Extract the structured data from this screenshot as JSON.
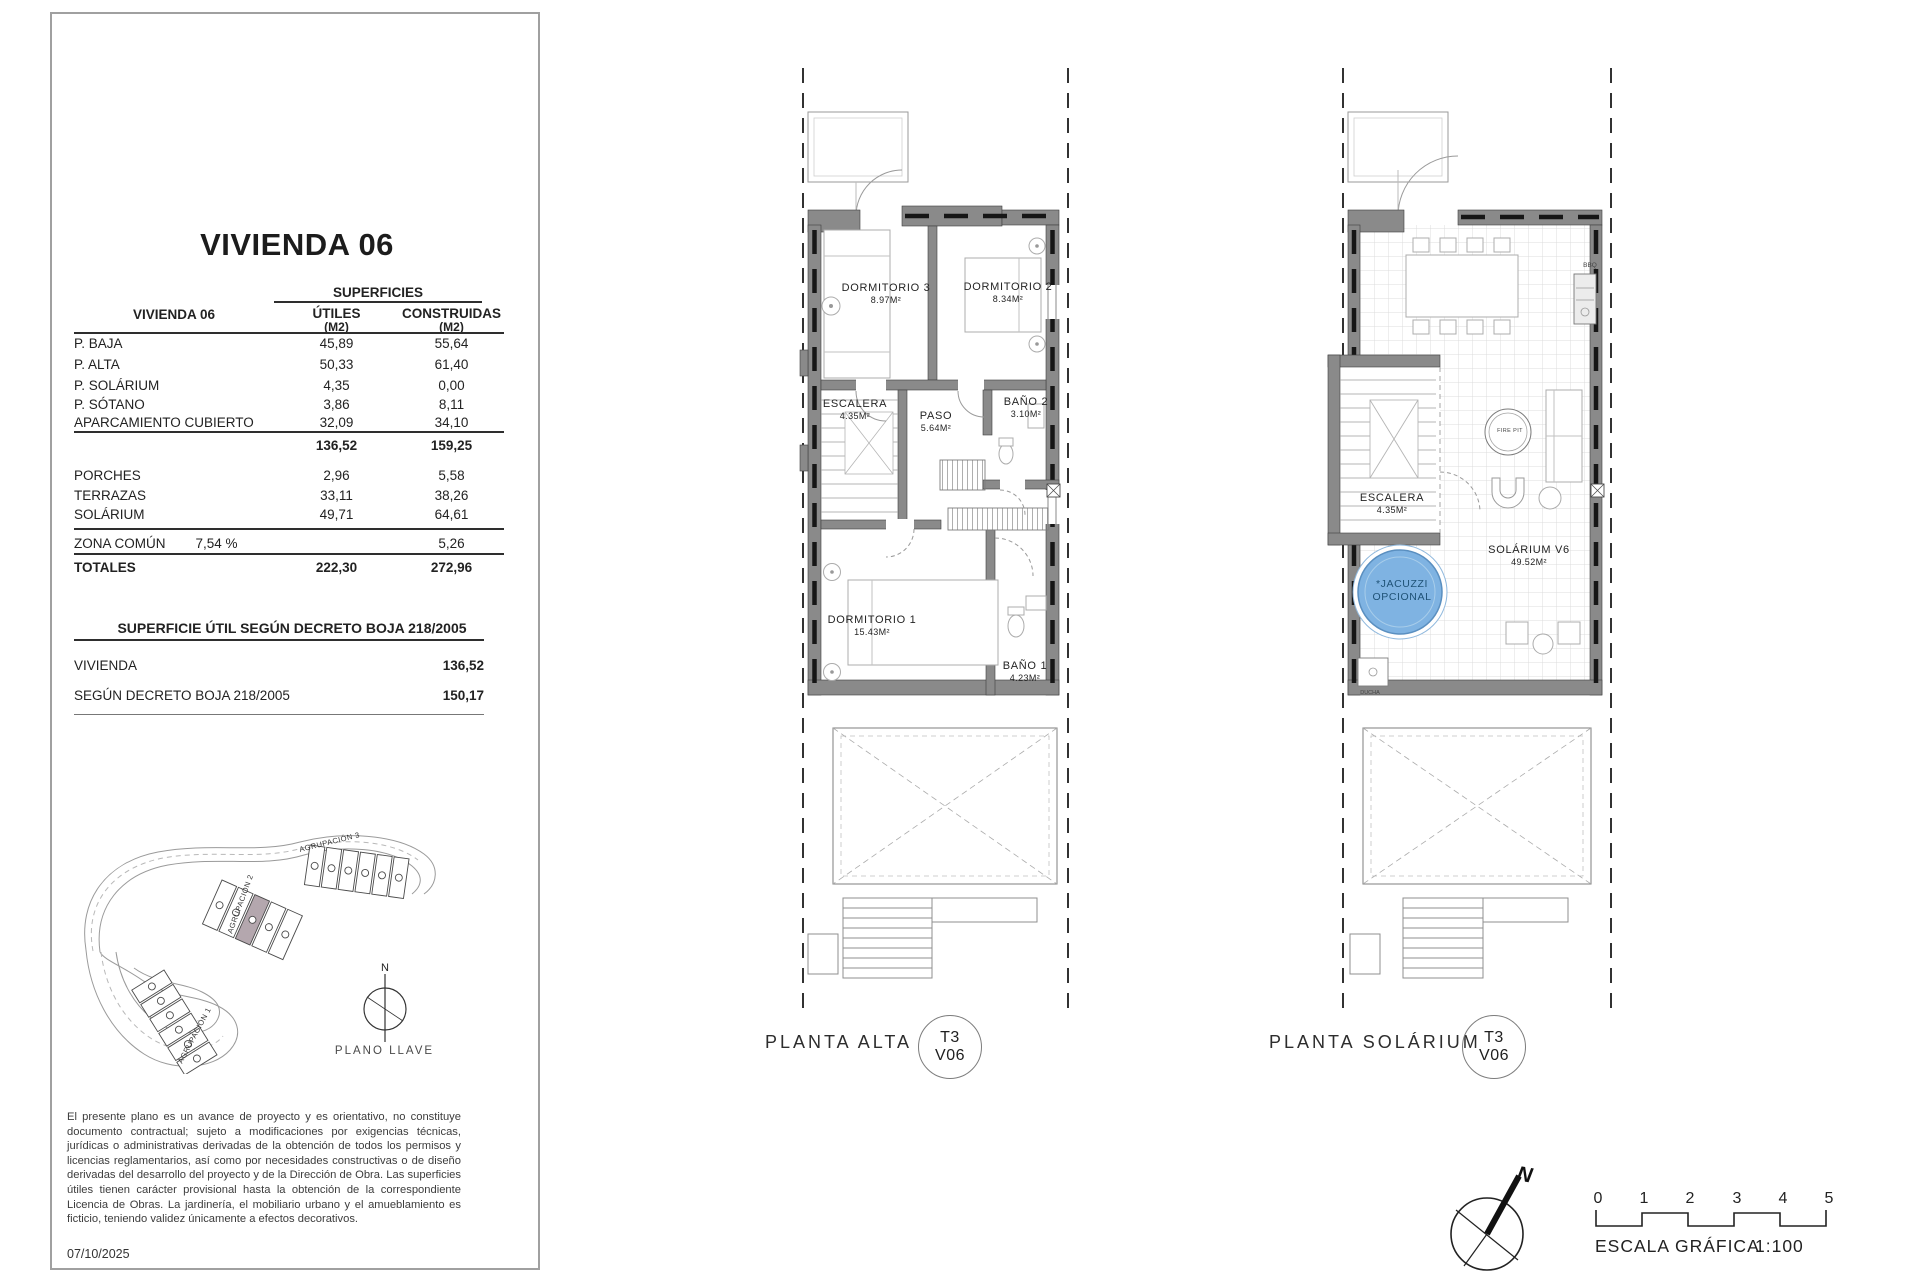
{
  "panel": {
    "title": "VIVIENDA 06",
    "table": {
      "group_header": "SUPERFICIES",
      "row_header": "VIVIENDA 06",
      "col_utiles": "ÚTILES",
      "col_construidas": "CONSTRUIDAS",
      "unit": "(M2)",
      "rows": [
        {
          "label": "P. BAJA",
          "utiles": "45,89",
          "construidas": "55,64"
        },
        {
          "label": "P. ALTA",
          "utiles": "50,33",
          "construidas": "61,40"
        },
        {
          "label": "P. SOLÁRIUM",
          "utiles": "4,35",
          "construidas": "0,00"
        },
        {
          "label": "P. SÓTANO",
          "utiles": "3,86",
          "construidas": "8,11"
        },
        {
          "label": "APARCAMIENTO CUBIERTO",
          "utiles": "32,09",
          "construidas": "34,10"
        }
      ],
      "subtotal": {
        "utiles": "136,52",
        "construidas": "159,25"
      },
      "extras": [
        {
          "label": "PORCHES",
          "utiles": "2,96",
          "construidas": "5,58"
        },
        {
          "label": "TERRAZAS",
          "utiles": "33,11",
          "construidas": "38,26"
        },
        {
          "label": "SOLÁRIUM",
          "utiles": "49,71",
          "construidas": "64,61"
        }
      ],
      "zona": {
        "label": "ZONA COMÚN",
        "pct": "7,54 %",
        "construidas": "5,26"
      },
      "totals": {
        "label": "TOTALES",
        "utiles": "222,30",
        "construidas": "272,96"
      }
    },
    "decreto": {
      "title": "SUPERFICIE ÚTIL SEGÚN DECRETO BOJA 218/2005",
      "rows": [
        {
          "label": "VIVIENDA",
          "value": "136,52"
        },
        {
          "label": "SEGÚN DECRETO BOJA 218/2005",
          "value": "150,17"
        }
      ]
    },
    "keyplan": {
      "agrupacion1": "AGRUPACIÓN 1",
      "agrupacion2": "AGRUPACIÓN 2",
      "agrupacion3": "AGRUPACIÓN 3",
      "north": "N",
      "caption": "PLANO LLAVE"
    },
    "disclaimer": "El presente plano es un avance de proyecto y es orientativo, no constituye documento contractual; sujeto a modificaciones por exigencias técnicas, jurídicas o administrativas derivadas de la obtención de todos los permisos y licencias reglamentarios, así como por necesidades constructivas o de diseño derivadas del desarrollo del proyecto y de la Dirección de Obra. Las superficies útiles tienen carácter provisional hasta la obtención de la correspondiente Licencia de Obras. La jardinería, el mobiliario urbano y el amueblamiento es ficticio, teniendo validez únicamente a efectos decorativos.",
    "date": "07/10/2025"
  },
  "planta_alta": {
    "caption": "PLANTA ALTA",
    "badge": {
      "type": "T3",
      "unit": "V06"
    },
    "rooms": {
      "dormitorio3": {
        "name": "DORMITORIO 3",
        "area": "8.97M²"
      },
      "dormitorio2": {
        "name": "DORMITORIO 2",
        "area": "8.34M²"
      },
      "escalera": {
        "name": "ESCALERA",
        "area": "4.35M²"
      },
      "paso": {
        "name": "PASO",
        "area": "5.64M²"
      },
      "bano2": {
        "name": "BAÑO 2",
        "area": "3.10M²"
      },
      "dormitorio1": {
        "name": "DORMITORIO 1",
        "area": "15.43M²"
      },
      "bano1": {
        "name": "BAÑO 1",
        "area": "4.23M²"
      }
    }
  },
  "planta_solarium": {
    "caption": "PLANTA SOLÁRIUM",
    "badge": {
      "type": "T3",
      "unit": "V06"
    },
    "rooms": {
      "escalera": {
        "name": "ESCALERA",
        "area": "4.35M²"
      },
      "solarium": {
        "name": "SOLÁRIUM V6",
        "area": "49.52M²"
      }
    },
    "jacuzzi_line1": "*JACUZZI",
    "jacuzzi_line2": "OPCIONAL",
    "fire_pit": "FIRE PIT",
    "bbq": "BBQ",
    "ducha": "DUCHA"
  },
  "scale_bar": {
    "ticks": [
      "0",
      "1",
      "2",
      "3",
      "4",
      "5"
    ],
    "caption": "ESCALA GRÁFICA",
    "ratio": "1:100",
    "north": "N"
  },
  "colors": {
    "wall": "#8a8a8a",
    "jacuzzi": "#7fb3e2",
    "jacuzzi_text": "#1f5276",
    "highlight_unit": "#b4a7ae"
  }
}
